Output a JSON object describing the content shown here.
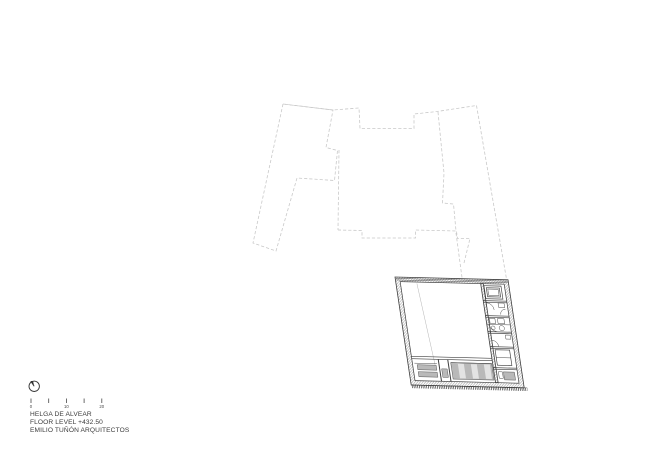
{
  "page": {
    "kind": "architectural floor plan sheet",
    "background_color": "#ffffff"
  },
  "title_block": {
    "line1": "HELGA DE ALVEAR",
    "line2": "FLOOR LEVEL +432.50",
    "line3": "EMILIO TUÑÓN ARQUITECTOS"
  },
  "scale_bar": {
    "labels": [
      "0",
      "10",
      "20"
    ],
    "tick_count": 5
  },
  "icons": {
    "north_arrow": "north-arrow-icon"
  },
  "drawing": {
    "site_outline_style": "dashed",
    "plan_level": "+432.50",
    "colors": {
      "background": "#ffffff",
      "site_outline": "#c9c9c9",
      "plan_line": "#3d3d3d",
      "hatch_line": "#8f8f8f",
      "stair_fill": "#b9b9b9",
      "stripe_fill": "#e3e3e3",
      "faint_line": "#b4b4b4",
      "text": "#3b3b3b"
    }
  }
}
